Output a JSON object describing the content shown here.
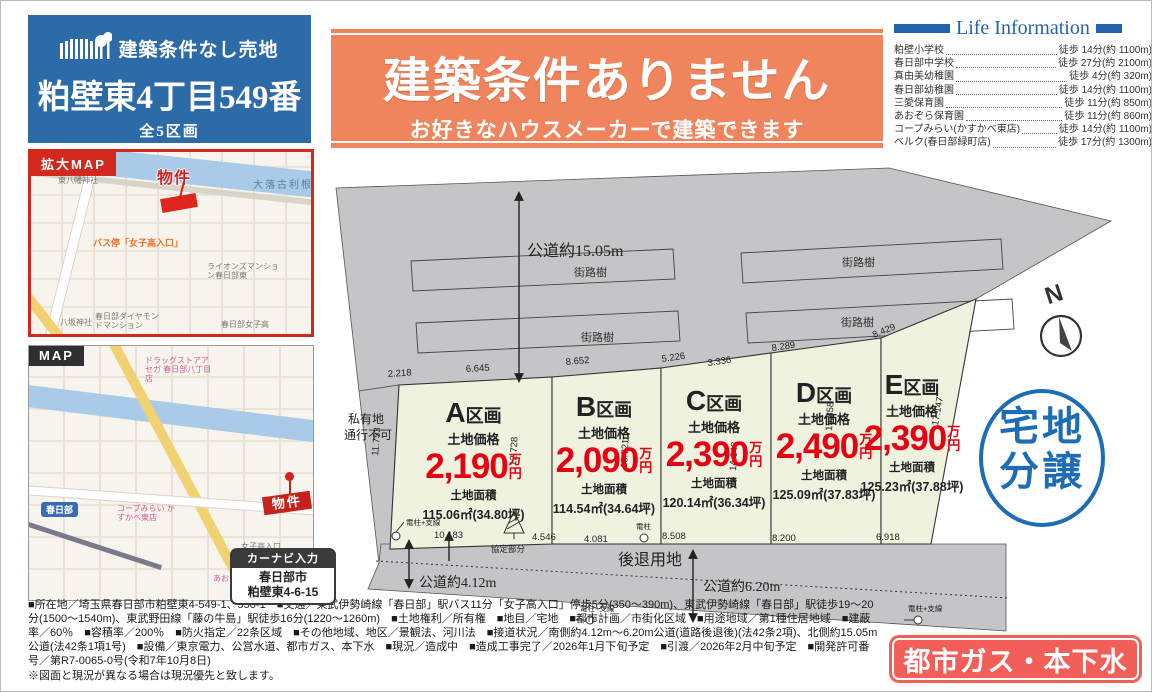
{
  "brand": {
    "tagline": "建築条件なし売地",
    "title": "粕壁東4丁目549番",
    "units": "全5区画"
  },
  "banner": {
    "title": "建築条件ありません",
    "subtitle": "お好きなハウスメーカーで建築できます"
  },
  "life_info": {
    "title": "Life Information",
    "items": [
      {
        "name": "粕壁小学校",
        "value": "徒歩 14分(約 1100m)"
      },
      {
        "name": "春日部中学校",
        "value": "徒歩 27分(約 2100m)"
      },
      {
        "name": "真由美幼稚園",
        "value": "徒歩 4分(約 320m)"
      },
      {
        "name": "春日部幼稚園",
        "value": "徒歩 14分(約 1100m)"
      },
      {
        "name": "三愛保育園",
        "value": "徒歩 11分(約 850m)"
      },
      {
        "name": "あおぞら保育園",
        "value": "徒歩 11分(約 860m)"
      },
      {
        "name": "コープみらい(かすかべ東店)",
        "value": "徒歩 14分(約 1100m)"
      },
      {
        "name": "ベルク(春日部緑町店)",
        "value": "徒歩 17分(約 1300m)"
      }
    ]
  },
  "map_enlarged": {
    "tab": "拡大MAP",
    "river": "大落古利根川",
    "property": "物件",
    "bus_stop": "バス停「女子高入口」",
    "poi": {
      "higashi_hachiman": "東八幡神社",
      "yasaka": "八坂神社",
      "diamond_mansion": "春日部ダイヤモンドマンション",
      "lions_mansion": "ライオンズマンション春日部東",
      "joshiko": "春日部女子高"
    }
  },
  "map_wide": {
    "tab": "MAP",
    "station": "春日部",
    "coop": "コープみらい かすかべ東店",
    "drugstore": "ドラッグストアアセガ 春日部八丁目店",
    "property": "物件",
    "joshiko_entrance": "女子高入口",
    "aozora": "あおぞら保育園",
    "navi": {
      "title": "カーナビ入力",
      "city": "春日部市",
      "address": "粕壁東4-6-15"
    }
  },
  "site_plan": {
    "labels": {
      "road_north": "公道約15.05m",
      "street_tree": "街路樹",
      "private1": "私有地",
      "private2": "通行不可",
      "setback": "後退用地",
      "road_south_left": "公道約4.12m",
      "road_south_right": "公道約6.20m",
      "agreement": "協定部分",
      "pole_wire": "電柱+支線",
      "pole": "電柱",
      "price_label": "土地価格",
      "area_label": "土地面積",
      "man": "万",
      "yen": "円"
    },
    "lots": [
      {
        "name": "A",
        "kukaku": "区画",
        "price": "2,190",
        "area": "115.06㎡(34.80坪)"
      },
      {
        "name": "B",
        "kukaku": "区画",
        "price": "2,090",
        "area": "114.54㎡(34.64坪)"
      },
      {
        "name": "C",
        "kukaku": "区画",
        "price": "2,390",
        "area": "120.14㎡(36.34坪)"
      },
      {
        "name": "D",
        "kukaku": "区画",
        "price": "2,490",
        "area": "125.09㎡(37.83坪)"
      },
      {
        "name": "E",
        "kukaku": "区画",
        "price": "2,390",
        "area": "125.23㎡(37.88坪)"
      }
    ],
    "dims": {
      "a_top_l": "2.218",
      "a_top": "6.645",
      "b_top": "8.652",
      "c_top_l": "5.226",
      "c_top_r": "3.336",
      "d_top": "8.289",
      "e_top": "8.429",
      "a_left": "11.753",
      "b_left": "12.728",
      "c_left": "13.721",
      "d_left": "14.648",
      "e_left": "15.858",
      "e_right": "17.147",
      "a_bottom": "10.183",
      "b_bottom_l": "4.546",
      "b_bottom_r": "4.081",
      "c_bottom": "8.508",
      "d_bottom": "8.200",
      "e_bottom": "6.918"
    }
  },
  "stamps": {
    "compass_n": "N",
    "sale_line1": "宅地",
    "sale_line2": "分譲",
    "utilities": "都市ガス・本下水"
  },
  "footer": {
    "details": "■所在地／埼玉県春日部市粕壁東4-549-1、550-1　■交通／東武伊勢崎線「春日部」駅バス11分「女子高入口」停歩5分(350〜390m)、東武伊勢崎線「春日部」駅徒歩19〜20分(1500〜1540m)、東武野田線「藤の牛島」駅徒歩16分(1220〜1260m)　■土地権利／所有権　■地目／宅地　■都市計画／市街化区域　■用途地域／第1種住居地域　■建蔽率／60％　■容積率／200％　■防火指定／22条区域　■その他地域、地区／景観法、河川法　■接道状況／南側約4.12m〜6.20m公道(道路後退後)(法42条2項)、北側約15.05m公道(法42条1項1号)　■設備／東京電力、公営水道、都市ガス、本下水　■現況／造成中　■造成工事完了／2026年1月下旬予定　■引渡／2026年2月中旬予定　■開発許可番号／第R7-0065-0号(令和7年10月8日)",
    "note": "※図面と現況が異なる場合は現況優先と致します。"
  }
}
